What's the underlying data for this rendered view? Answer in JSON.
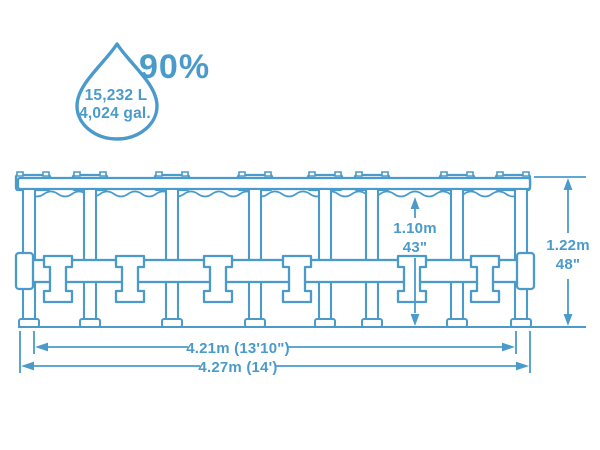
{
  "colors": {
    "accent": "#4A9BCB",
    "background": "#FFFFFF"
  },
  "capacity": {
    "percent": "90%",
    "volume_liters": "15,232 L",
    "volume_gallons": "4,024 gal."
  },
  "dimensions": {
    "water_height_metric": "1.10m",
    "water_height_imperial": "43\"",
    "wall_height_metric": "1.22m",
    "wall_height_imperial": "48\"",
    "frame_diameter": "4.21m (13'10\")",
    "outer_diameter": "4.27m (14')"
  }
}
